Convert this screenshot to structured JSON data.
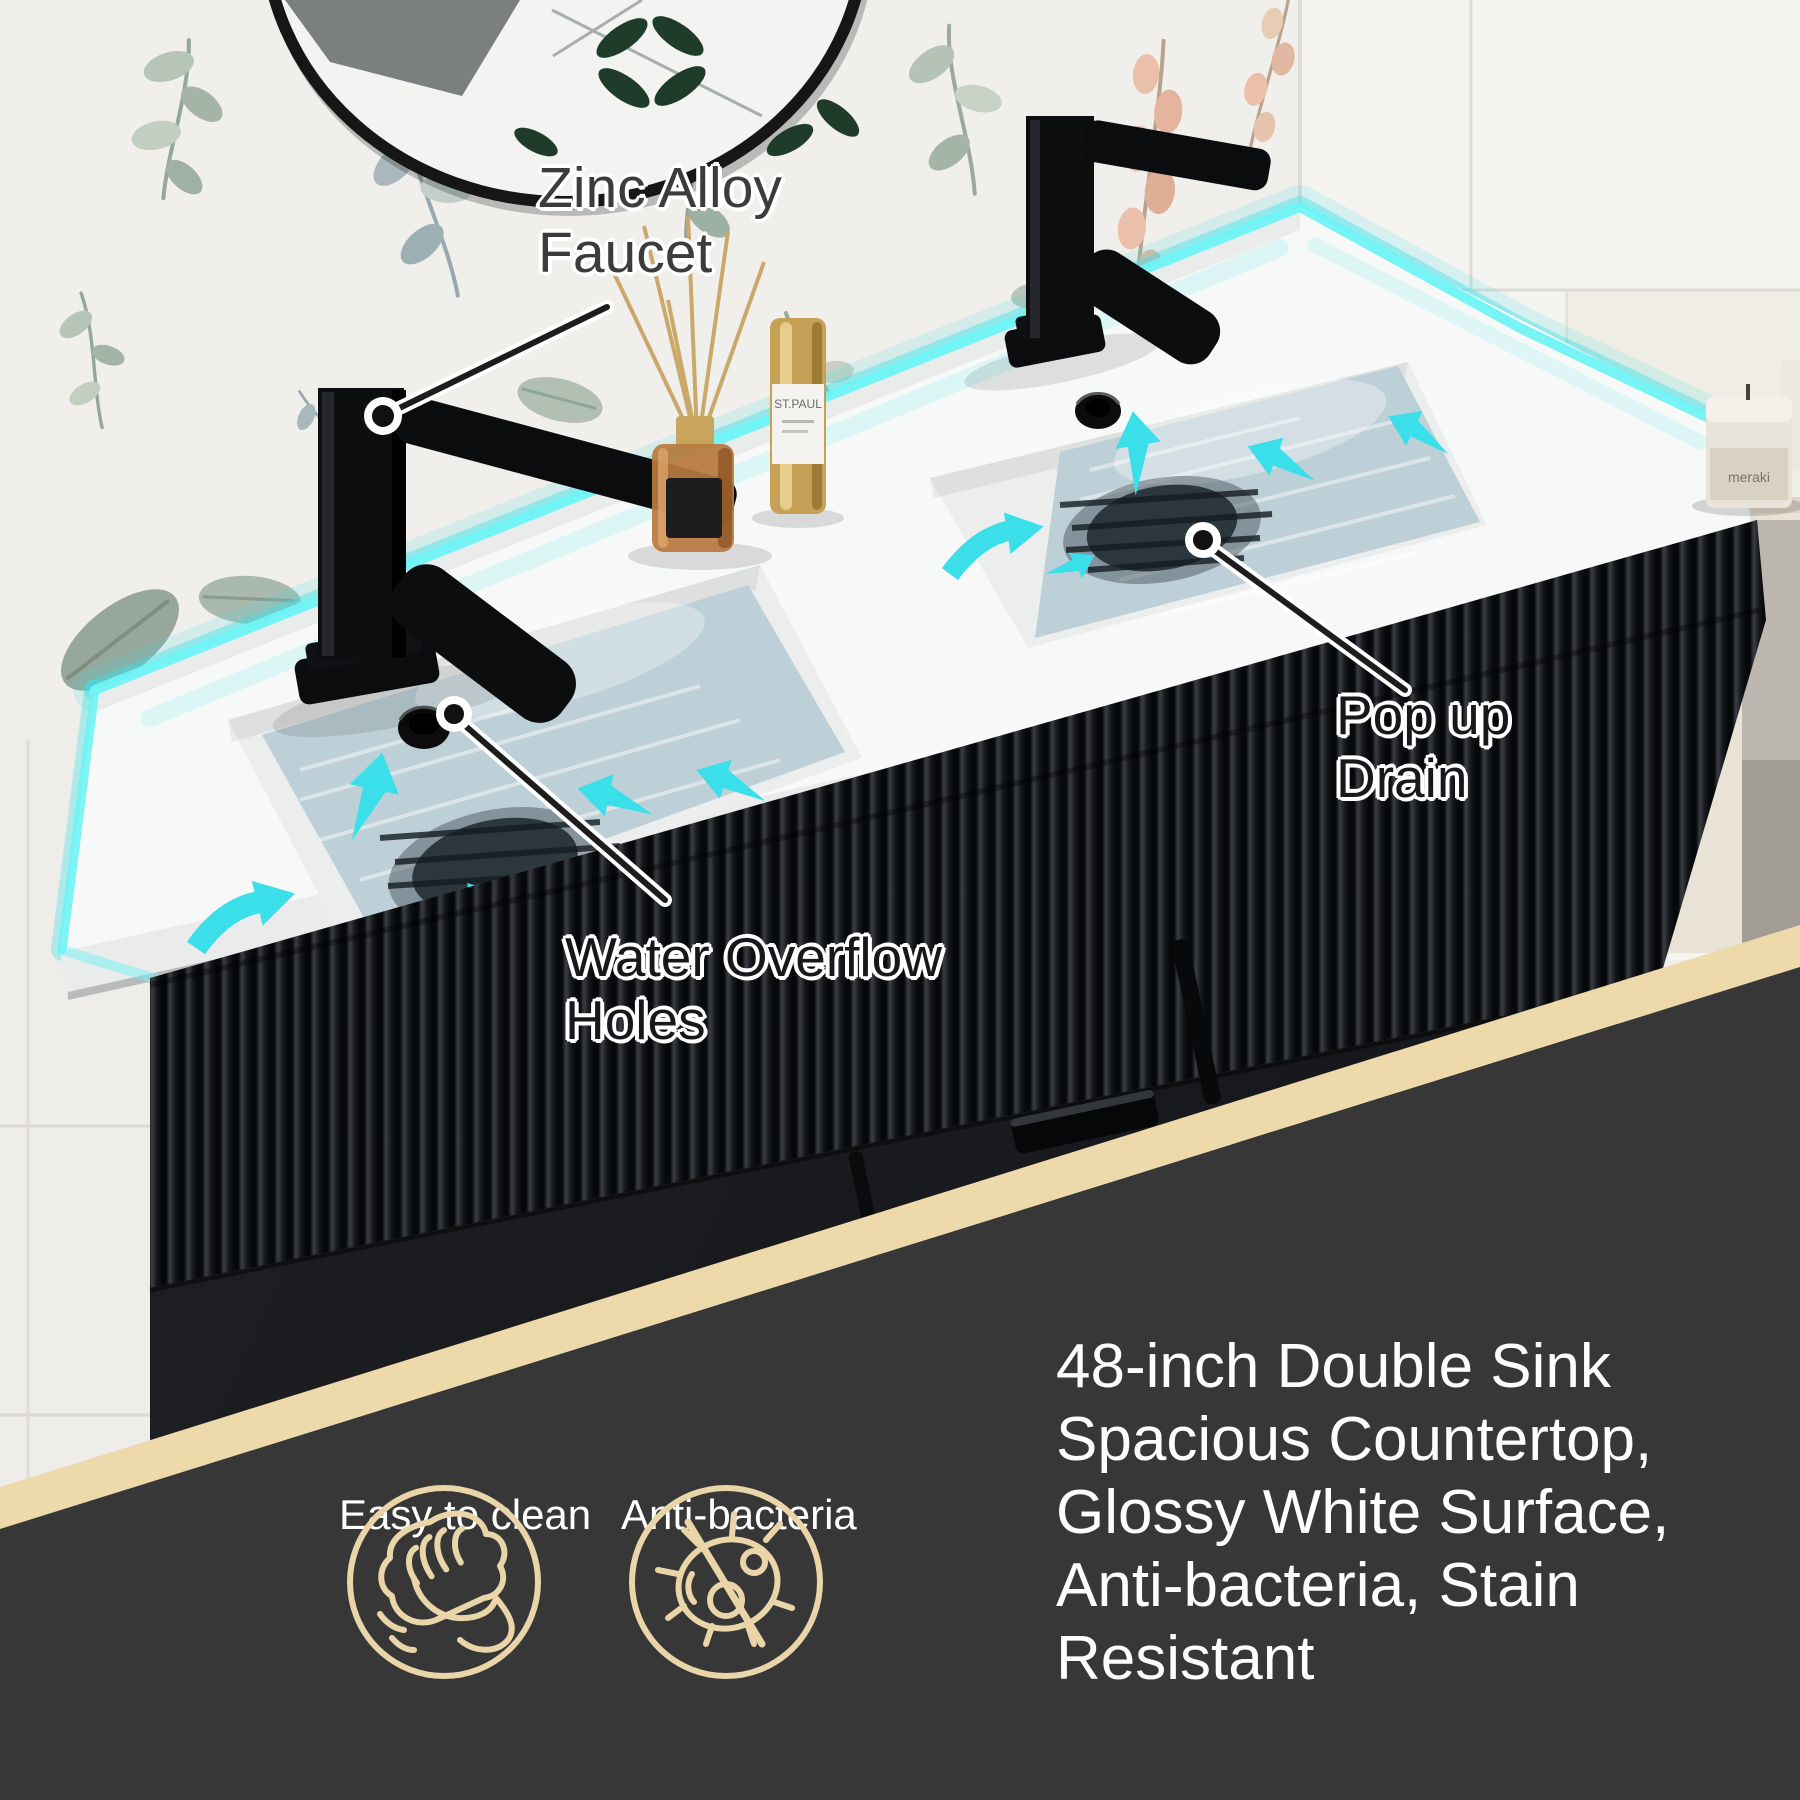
{
  "callouts": {
    "faucet": {
      "line1": "Zinc Alloy",
      "line2": "Faucet"
    },
    "overflow": {
      "line1": "Water Overflow",
      "line2": "Holes"
    },
    "drain": {
      "line1": "Pop up",
      "line2": "Drain"
    }
  },
  "feature_panel": {
    "description_lines": [
      "48-inch Double Sink",
      "Spacious Countertop,",
      "Glossy White Surface,",
      "Anti-bacteria, Stain",
      "Resistant"
    ],
    "badges": [
      {
        "icon": "wipe-hand-icon",
        "label": "Easy to clean"
      },
      {
        "icon": "no-bacteria-icon",
        "label": "Anti-bacteria"
      }
    ]
  },
  "accessories": {
    "spray_bottle_label": "ST.PAUL",
    "candle_label": "meraki"
  },
  "colors": {
    "accent_teal": "#3adfe9",
    "divider_tan": "#eed9ab",
    "panel_gray": "#373737",
    "icon_gold": "#e9d5a8"
  }
}
